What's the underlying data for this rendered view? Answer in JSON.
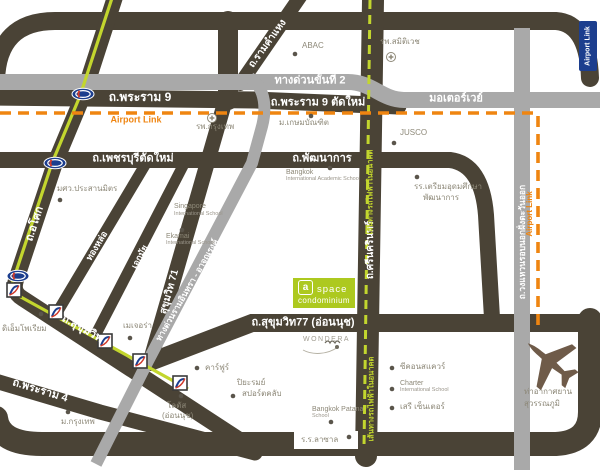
{
  "colors": {
    "road_dark": "#4a4336",
    "road_gray": "#a9a9a9",
    "rail_green": "#c3d62e",
    "airport_link_orange": "#ef8511",
    "navy": "#1c3e8e",
    "logo_green": "#adc91f",
    "poi_text": "#8d8878"
  },
  "roads": {
    "rama9": "ถ.พระราม 9",
    "rama9_new": "ถ.พระราม 9 ตัดใหม่",
    "expressway2": "ทางด่วนขั้นที่ 2",
    "motorway": "มอเตอร์เวย์",
    "phetchaburi_new": "ถ.เพชรบุรีตัดใหม่",
    "phatthanakan": "ถ.พัฒนาการ",
    "ramkhamhaeng": "ถ.รามคำแหง",
    "asok": "ถ.อโศก",
    "thonglor": "ทองหล่อ",
    "ekkamai": "เอกมัย",
    "sukhumvit71": "สุขุมวิท 71",
    "sukhumvit": "ถ.สุขุมวิท",
    "rama4": "ถ.พระราม 4",
    "sukhumvit77": "ถ.สุขุมวิท77 (อ่อนนุช)",
    "srinakarin": "ถ.ศรีนครินทร์",
    "outer_ring": "ถ.วงแหวนรอบนอกฝั่งตะวันออก",
    "ramintra_expwy": "ทางด่วนรามอินทรา - อาจณรงค์"
  },
  "transit": {
    "airport_link": "Airport Link",
    "future_rail": "เส้นทางรถไฟฟ้าในอนาคต"
  },
  "logo": {
    "badge": "a",
    "name": "space",
    "sub": "condominium"
  },
  "wondera": "WONDERA",
  "places": {
    "abac": "ABAC",
    "samitivej": "รพ.สมิติเวช",
    "bangkok_hospital": "รพ.กรุงเทพ",
    "kasem_bundit": "ม.เกษมบัณฑิต",
    "jusco": "JUSCO",
    "swu_prasarnmit": "มศว.ประสานมิตร",
    "singapore_school": {
      "l1": "Singapore",
      "l2": "International School"
    },
    "bkk_intl_academic": {
      "l1": "Bangkok",
      "l2": "International Academic School"
    },
    "triam_udom": {
      "l1": "รร.เตรียมอุดมศึกษา",
      "l2": "พัฒนาการ"
    },
    "ekamai_intl": {
      "l1": "Ekamai",
      "l2": "International School"
    },
    "emporium": "ดิเอ็มโพเรียม",
    "major": "เมเจอร่า",
    "carrefour": "คาร์ฟูร์",
    "piyarom": {
      "l1": "ปิยะรมย์",
      "l2": "สปอร์ตคลับ"
    },
    "lotus": {
      "l1": "โลตัส",
      "l2": "(อ่อนนุช)"
    },
    "bangkok_university": "ม.กรุงเทพ",
    "bangkok_patana": {
      "l1": "Bangkok Patana",
      "l2": "School"
    },
    "lasalle": "ร.ร.ลาซาล",
    "seacon": "ซีคอนสแควร์",
    "charter": {
      "l1": "Charter",
      "l2": "International School"
    },
    "seri_center": "เสรี เซ็นเตอร์",
    "suvarnabhumi": {
      "l1": "ท่าอากาศยาน",
      "l2": "สุวรรณภูมิ"
    }
  }
}
